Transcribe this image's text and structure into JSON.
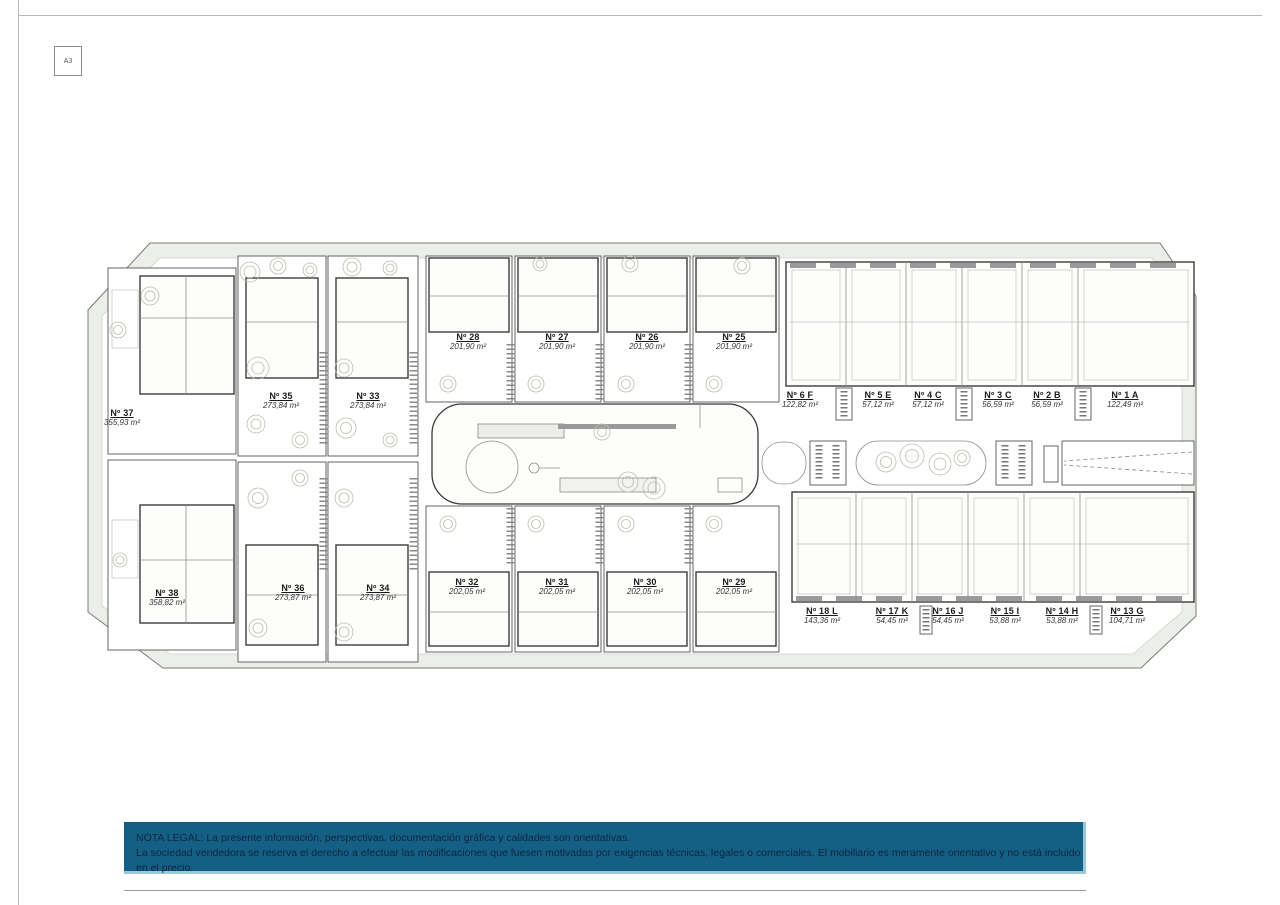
{
  "sheet": {
    "format_label": "A3"
  },
  "legal": {
    "line1": "NOTA LEGAL: La presente información, perspectivas, documentación gráfica y calidades son orientativas.",
    "line2": "La sociedad vendedora se reserva el derecho a efectuar las modificaciones que fuesen motivadas por exigencias técnicas, legales o comerciales. El mobiliario es meramente orientativo y no está incluido en el precio.",
    "bar_color": "#155f84"
  },
  "units": [
    {
      "number": "Nº 37",
      "area": "355,93 m²"
    },
    {
      "number": "Nº 35",
      "area": "273,84 m²"
    },
    {
      "number": "Nº 33",
      "area": "273,84 m²"
    },
    {
      "number": "Nº 28",
      "area": "201,90 m²"
    },
    {
      "number": "Nº 27",
      "area": "201,90 m²"
    },
    {
      "number": "Nº 26",
      "area": "201,90 m²"
    },
    {
      "number": "Nº 25",
      "area": "201,90 m²"
    },
    {
      "number": "Nº 6 F",
      "area": "122,82 m²"
    },
    {
      "number": "Nº 5 E",
      "area": "57,12 m²"
    },
    {
      "number": "Nº 4 C",
      "area": "57,12 m²"
    },
    {
      "number": "Nº 3 C",
      "area": "56,59 m²"
    },
    {
      "number": "Nº 2 B",
      "area": "56,59 m²"
    },
    {
      "number": "Nº 1 A",
      "area": "122,49 m²"
    },
    {
      "number": "Nº 38",
      "area": "358,82 m²"
    },
    {
      "number": "Nº 36",
      "area": "273,87 m²"
    },
    {
      "number": "Nº 34",
      "area": "273,87 m²"
    },
    {
      "number": "Nº 32",
      "area": "202,05 m²"
    },
    {
      "number": "Nº 31",
      "area": "202,05 m²"
    },
    {
      "number": "Nº 30",
      "area": "202,05 m²"
    },
    {
      "number": "Nº 29",
      "area": "202,05 m²"
    },
    {
      "number": "Nº 18 L",
      "area": "143,36 m²"
    },
    {
      "number": "Nº 17 K",
      "area": "54,45 m²"
    },
    {
      "number": "Nº 16 J",
      "area": "54,45 m²"
    },
    {
      "number": "Nº 15 I",
      "area": "53,88 m²"
    },
    {
      "number": "Nº 14 H",
      "area": "53,88 m²"
    },
    {
      "number": "Nº 13 G",
      "area": "104,71 m²"
    }
  ]
}
